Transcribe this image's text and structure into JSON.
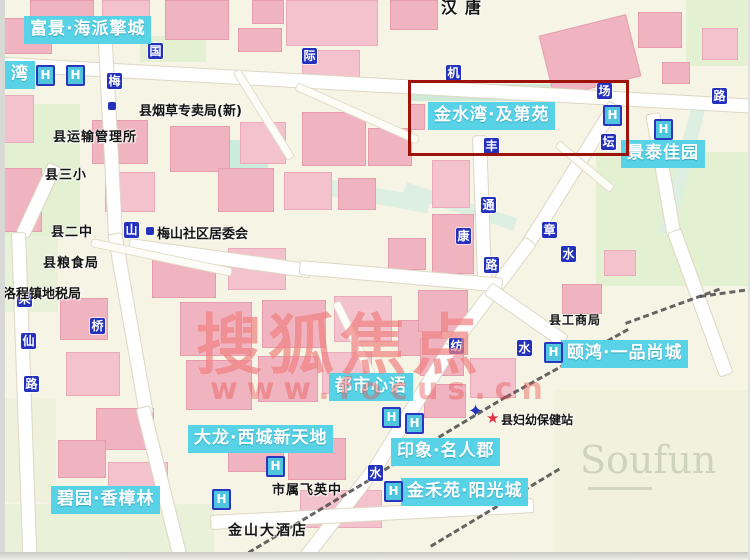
{
  "colors": {
    "estate_label_bg": "#57d2e6",
    "estate_label_text": "#ffffff",
    "road_marker_blue": "#2431bd",
    "highlight_red": "#9e120c",
    "watermark_red": "#e95454",
    "building_pink": "#f0b3c0",
    "park_green": "#e3f0d2"
  },
  "icons": {
    "hotel": "H",
    "star": "★",
    "cross": "✦"
  },
  "watermark": {
    "main": "搜狐焦点",
    "sub": "www.focus.cn"
  },
  "corner_watermark": "Soufun",
  "highlight": {
    "estate": "金水湾·及第苑",
    "x": 408,
    "y": 80,
    "w": 215,
    "h": 70
  },
  "estates": [
    {
      "text": "富景·海派擎城",
      "x": 24,
      "y": 16
    },
    {
      "text": "湾",
      "x": 5,
      "y": 61
    },
    {
      "text": "金水湾·及第苑",
      "x": 428,
      "y": 102
    },
    {
      "text": "景泰佳园",
      "x": 621,
      "y": 140
    },
    {
      "text": "颐鸿·一品尚城",
      "x": 561,
      "y": 340
    },
    {
      "text": "都市心语",
      "x": 329,
      "y": 373
    },
    {
      "text": "大龙·西城新天地",
      "x": 188,
      "y": 425
    },
    {
      "text": "印象·名人郡",
      "x": 391,
      "y": 438
    },
    {
      "text": "金禾苑·阳光城",
      "x": 401,
      "y": 478
    },
    {
      "text": "碧园·香樟林",
      "x": 51,
      "y": 486
    }
  ],
  "pois": [
    {
      "text": "汉唐",
      "x": 441,
      "y": -6,
      "fs": 16,
      "ls": 8
    },
    {
      "text": "县烟草专卖局(新)",
      "x": 139,
      "y": 100,
      "fs": 13,
      "ls": 0
    },
    {
      "text": "县运输管理所",
      "x": 53,
      "y": 126,
      "fs": 13,
      "ls": 1
    },
    {
      "text": "县三小",
      "x": 45,
      "y": 164,
      "fs": 13,
      "ls": 1
    },
    {
      "text": "县二中",
      "x": 51,
      "y": 221,
      "fs": 13,
      "ls": 1
    },
    {
      "text": "梅山社区居委会",
      "x": 157,
      "y": 223,
      "fs": 13,
      "ls": 0
    },
    {
      "text": "县粮食局",
      "x": 43,
      "y": 252,
      "fs": 13,
      "ls": 1
    },
    {
      "text": "洛程镇地税局",
      "x": 3,
      "y": 283,
      "fs": 13,
      "ls": 0
    },
    {
      "text": "县工商局",
      "x": 549,
      "y": 311,
      "fs": 12,
      "ls": 1
    },
    {
      "text": "县妇幼保健站",
      "x": 501,
      "y": 411,
      "fs": 12,
      "ls": 0
    },
    {
      "text": "市属飞英中",
      "x": 272,
      "y": 479,
      "fs": 13,
      "ls": 1
    },
    {
      "text": "金山大酒店",
      "x": 228,
      "y": 520,
      "fs": 14,
      "ls": 2
    }
  ],
  "road_markers": [
    {
      "ch": "国",
      "x": 148,
      "y": 43
    },
    {
      "ch": "际",
      "x": 302,
      "y": 48
    },
    {
      "ch": "机",
      "x": 446,
      "y": 65
    },
    {
      "ch": "场",
      "x": 597,
      "y": 83
    },
    {
      "ch": "路",
      "x": 712,
      "y": 88
    },
    {
      "ch": "梅",
      "x": 107,
      "y": 73
    },
    {
      "ch": "山",
      "x": 124,
      "y": 222
    },
    {
      "ch": "采",
      "x": 17,
      "y": 291
    },
    {
      "ch": "仙",
      "x": 21,
      "y": 333
    },
    {
      "ch": "路",
      "x": 24,
      "y": 376
    },
    {
      "ch": "桥",
      "x": 90,
      "y": 318
    },
    {
      "ch": "丰",
      "x": 484,
      "y": 138
    },
    {
      "ch": "通",
      "x": 481,
      "y": 197
    },
    {
      "ch": "康",
      "x": 456,
      "y": 228
    },
    {
      "ch": "路",
      "x": 484,
      "y": 257
    },
    {
      "ch": "章",
      "x": 542,
      "y": 222
    },
    {
      "ch": "水",
      "x": 561,
      "y": 246
    },
    {
      "ch": "坛",
      "x": 601,
      "y": 134
    },
    {
      "ch": "纺",
      "x": 449,
      "y": 338
    },
    {
      "ch": "水",
      "x": 517,
      "y": 340
    },
    {
      "ch": "水",
      "x": 368,
      "y": 465
    }
  ],
  "h_markers": [
    {
      "x": 36,
      "y": 65
    },
    {
      "x": 66,
      "y": 65
    },
    {
      "x": 603,
      "y": 105
    },
    {
      "x": 654,
      "y": 119
    },
    {
      "x": 544,
      "y": 342
    },
    {
      "x": 382,
      "y": 407
    },
    {
      "x": 405,
      "y": 413
    },
    {
      "x": 266,
      "y": 456
    },
    {
      "x": 212,
      "y": 489
    },
    {
      "x": 384,
      "y": 481
    }
  ],
  "star_marker": {
    "x": 486,
    "y": 411
  },
  "cross_marker": {
    "x": 468,
    "y": 403
  }
}
